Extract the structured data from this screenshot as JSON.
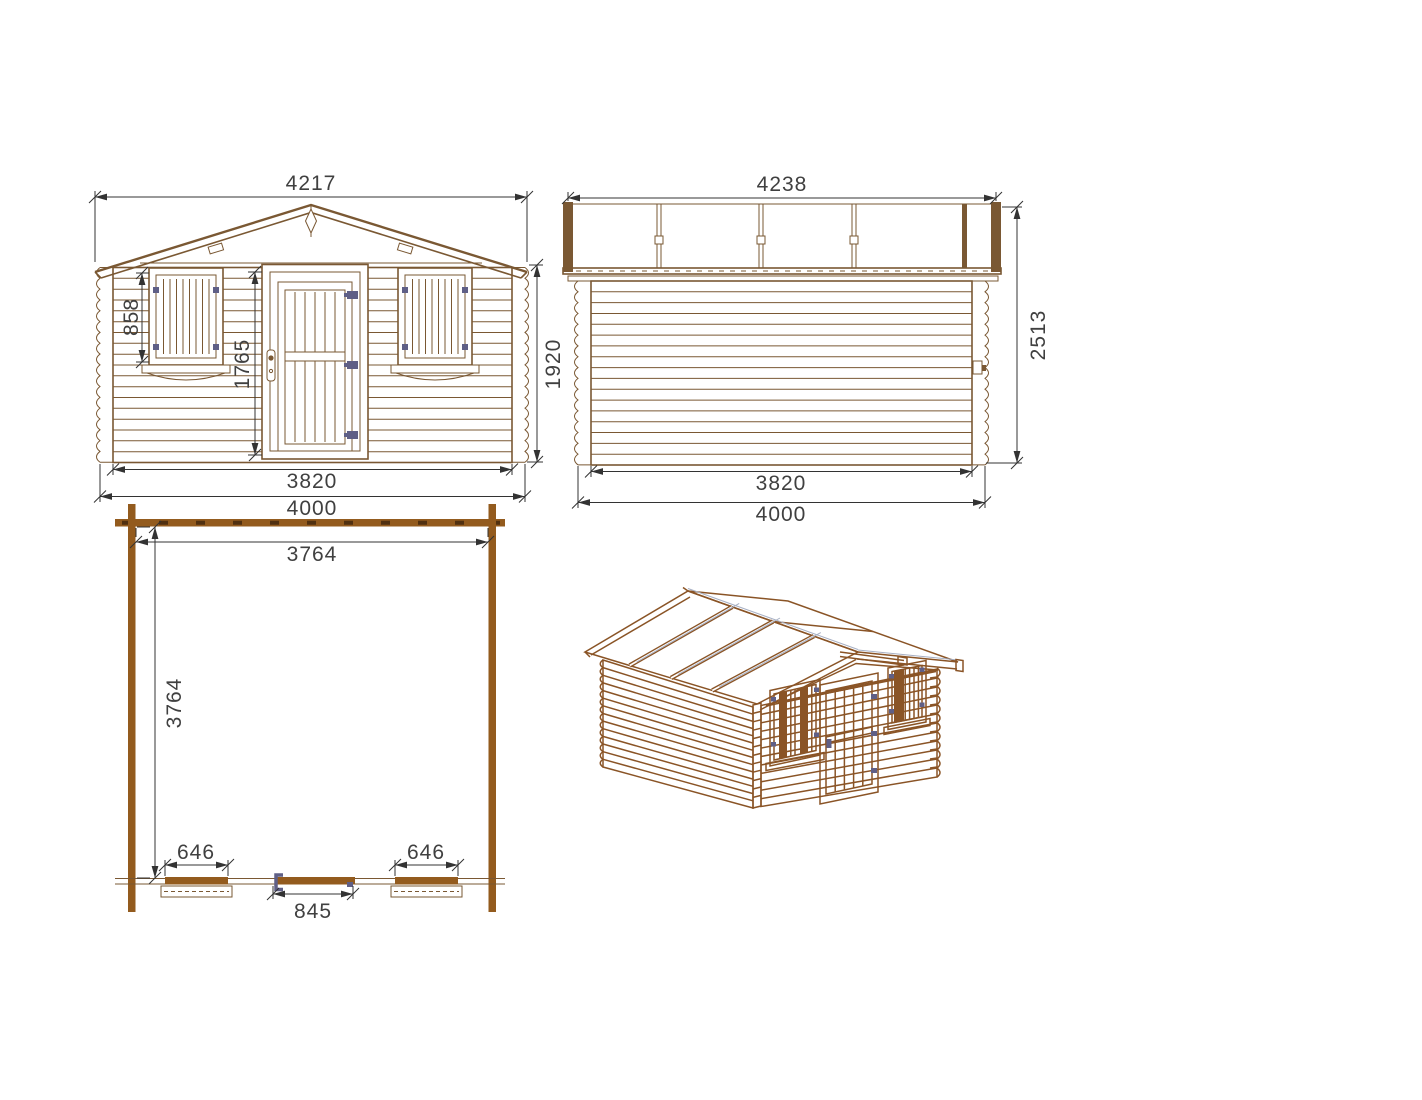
{
  "drawing": {
    "front": {
      "roof_width": "4217",
      "window_height": "858",
      "door_height": "1765",
      "wall_height": "1920",
      "base_length": "3820",
      "overall_length": "4000"
    },
    "side": {
      "roof_length": "4238",
      "total_height": "2513",
      "base_length": "3820",
      "overall_length": "4000"
    },
    "plan": {
      "inner_width": "3764",
      "inner_depth": "3764",
      "window_left": "646",
      "door_width": "845",
      "window_right": "646"
    }
  },
  "colors": {
    "bg": "#FFFFFF",
    "wood": "#7A5833",
    "wood3d": "#8A5426",
    "planwall": "#935B1E",
    "plandash": "#503010",
    "dim": "#333333",
    "text": "#404040",
    "hardware": "#5F5F86",
    "paneledge": "#A7B0C4"
  }
}
